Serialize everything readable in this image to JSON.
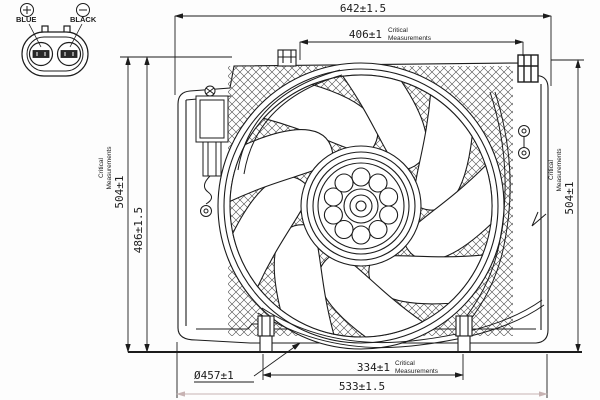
{
  "drawing": {
    "type": "technical-drawing",
    "subject": "radiator-cooling-fan-assembly",
    "connector": {
      "positive_symbol": "+",
      "negative_symbol": "−",
      "positive_terminal": "BLUE",
      "negative_terminal": "BLACK"
    },
    "dimensions": {
      "overall_width": "642±1.5",
      "mounting_width": "406±1",
      "overall_height_left": "504±1",
      "shroud_height": "486±1.5",
      "overall_height_right": "504±1",
      "fan_diameter": "Ø457±1",
      "feet_spacing": "334±1",
      "bottom_width": "533±1.5"
    },
    "critical_note": {
      "line1": "Critical",
      "line2": "Measurements"
    }
  },
  "colors": {
    "line": "#1c1c1c",
    "faded_dim": "#c7b3b3",
    "hatch": "#4a4a4a",
    "background": "#ffffff"
  }
}
